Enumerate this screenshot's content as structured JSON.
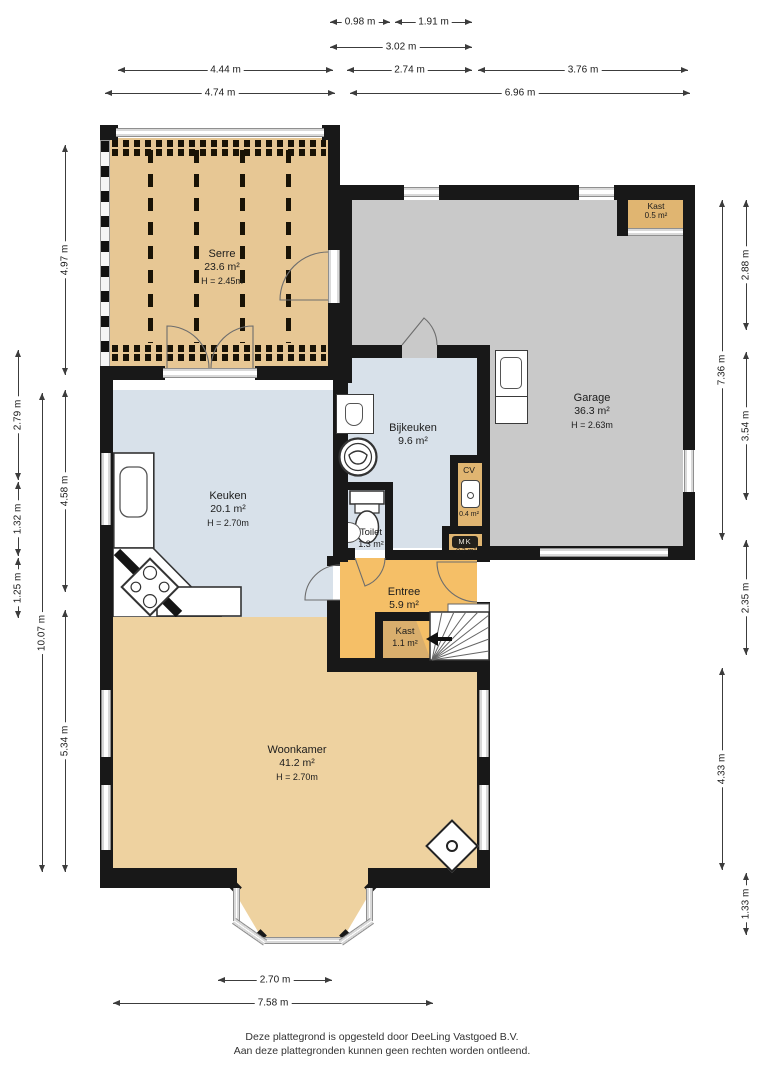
{
  "rooms": {
    "serre": {
      "name": "Serre",
      "area": "23.6 m²",
      "ceiling": "H = 2.45m"
    },
    "garage": {
      "name": "Garage",
      "area": "36.3 m²",
      "ceiling": "H = 2.63m"
    },
    "kast_garage": {
      "name": "Kast",
      "area": "0.5 m²"
    },
    "bijkeuken": {
      "name": "Bijkeuken",
      "area": "9.6 m²"
    },
    "keuken": {
      "name": "Keuken",
      "area": "20.1 m²",
      "ceiling": "H = 2.70m"
    },
    "toilet": {
      "name": "Toilet",
      "area": "1.3 m²"
    },
    "cv": {
      "name": "CV",
      "area": "0.4 m²"
    },
    "meterkast": {
      "name": "MK",
      "area": "0.3 m²"
    },
    "entree": {
      "name": "Entree",
      "area": "5.9 m²"
    },
    "kast_hal": {
      "name": "Kast",
      "area": "1.1 m²"
    },
    "woonkamer": {
      "name": "Woonkamer",
      "area": "41.2 m²",
      "ceiling": "H = 2.70m"
    }
  },
  "dimensions": {
    "top": [
      "0.98 m",
      "1.91 m",
      "3.02 m",
      "4.44 m",
      "2.74 m",
      "3.76 m",
      "4.74 m",
      "6.96 m"
    ],
    "left": [
      "4.97 m",
      "2.79 m",
      "1.32 m",
      "1.25 m",
      "4.58 m",
      "10.07 m",
      "5.34 m"
    ],
    "right": [
      "2.88 m",
      "7.36 m",
      "3.54 m",
      "2.35 m",
      "4.33 m",
      "1.33 m"
    ],
    "bottom": [
      "2.70 m",
      "7.58 m"
    ]
  },
  "footer": {
    "line1": "Deze plattegrond is opgesteld door DeeLing Vastgoed B.V.",
    "line2": "Aan deze plattegronden kunnen geen rechten worden ontleend."
  },
  "colors": {
    "wall": "#181818",
    "serre_floor": "#e7c794",
    "woonkamer_floor": "#eed2a0",
    "entree_floor": "#f5bf67",
    "closet_floor": "#e0b571",
    "kast_hal_floor": "#d9ae6d",
    "wet_room_floor": "#d8e1ea",
    "garage_floor": "#c9c9c9",
    "dimension_line": "#3c3c3c"
  }
}
